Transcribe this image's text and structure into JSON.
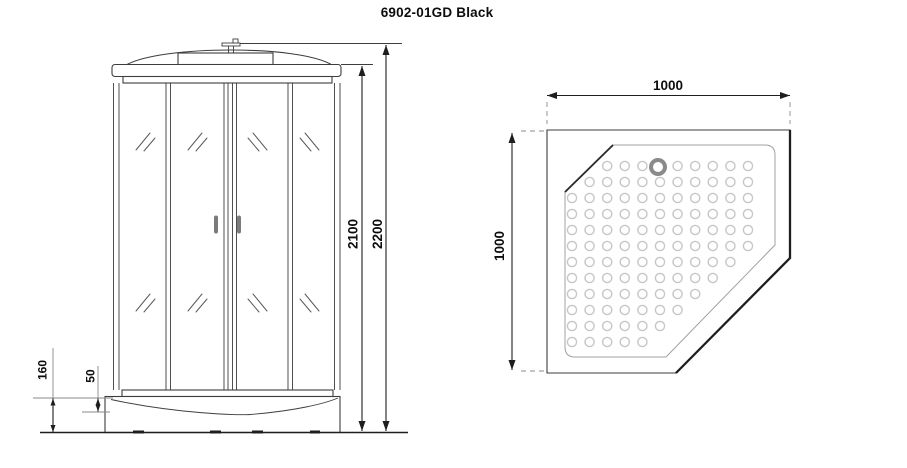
{
  "title": "6902-01GD Black",
  "front_view": {
    "description": "front elevation of shower cabin with four glass panels, roof canopy, top box and shower tray",
    "labels": {
      "cabin_height": "2100",
      "total_height": "2200",
      "tray_height": "160",
      "tray_step": "50"
    }
  },
  "top_view": {
    "description": "plan view of pentagonal corner shower tray with anti-slip dimples and drain",
    "labels": {
      "width": "1000",
      "depth": "1000"
    },
    "drain": {
      "cx": 658,
      "cy": 167,
      "r": 7,
      "stroke_width": 4
    },
    "dimples": {
      "x_start": 572,
      "x_step": 17.6,
      "cols": 11,
      "y_start": 166,
      "y_step": 16,
      "rows": 12,
      "radius": 4.6,
      "chamfer": {
        "x0": 613,
        "y0": 145,
        "slope": -0.98,
        "margin": 12
      },
      "diagonal": {
        "x0": 775,
        "y0": 245,
        "slope": -1.028,
        "margin": 22
      },
      "bounds": {
        "x_min": 571,
        "x_max": 762,
        "y_min": 158,
        "y_max": 346
      },
      "drain_clearance": 12
    }
  },
  "colors": {
    "line": "#3d3d3d",
    "strong_line": "#1e1e1e",
    "light_line": "#a0a0a0",
    "ext_line": "#8a8a8a",
    "dimple": "#c7c7c7",
    "drain": "#8a8a8a",
    "handle": "#7b7b7b",
    "text": "#0d0d0d"
  }
}
